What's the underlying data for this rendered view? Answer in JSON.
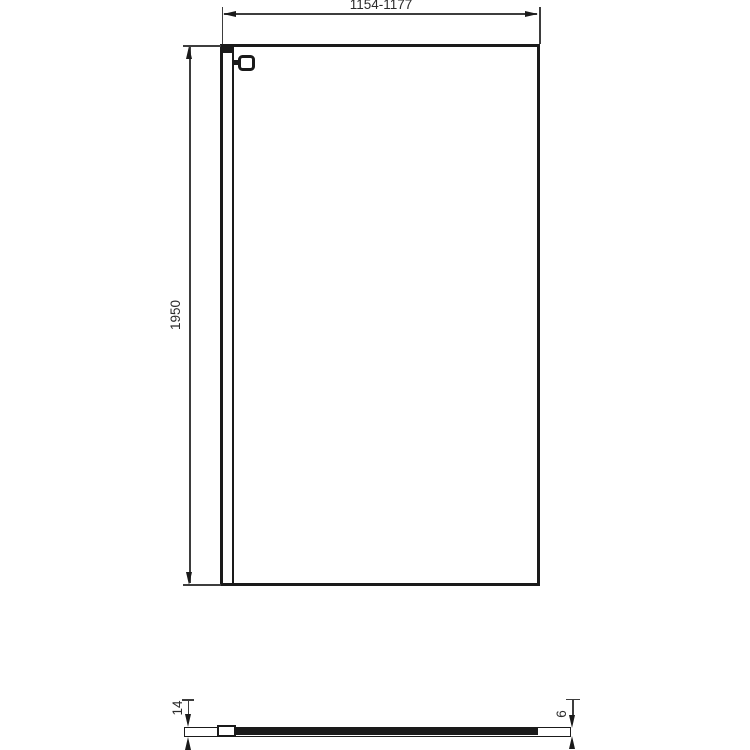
{
  "drawing": {
    "kind": "technical-dimension-drawing",
    "colors": {
      "background": "#ffffff",
      "object_line": "#1a1a1a",
      "dimension_line": "#3d3d3d",
      "text": "#2b2b2b"
    },
    "front_view": {
      "width_dimension": "1154-1177",
      "height_dimension": "1950"
    },
    "plan_view": {
      "profile_depth_dimension": "14",
      "glass_thickness_dimension": "6"
    }
  }
}
